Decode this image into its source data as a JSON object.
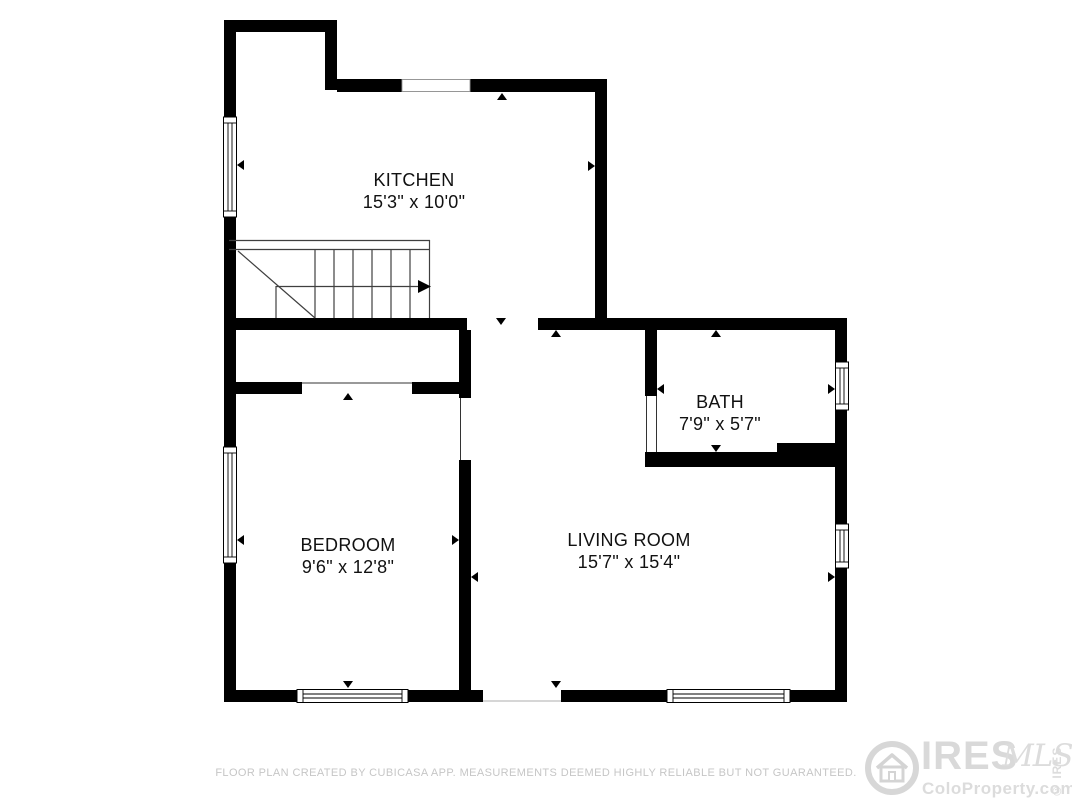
{
  "rooms": [
    {
      "name": "KITCHEN",
      "dims": "15'3\" x 10'0\"",
      "cx": 414,
      "cy": 180
    },
    {
      "name": "BATH",
      "dims": "7'9\" x 5'7\"",
      "cx": 720,
      "cy": 402
    },
    {
      "name": "BEDROOM",
      "dims": "9'6\" x 12'8\"",
      "cx": 348,
      "cy": 545
    },
    {
      "name": "LIVING ROOM",
      "dims": "15'7\" x 15'4\"",
      "cx": 629,
      "cy": 540
    }
  ],
  "plan": {
    "wall_color": "#000000",
    "stair_line_color": "#3f3f3f",
    "window_line_color": "#000000",
    "faint_line_color": "#c8c8c8",
    "walls": [
      [
        224,
        20,
        113,
        12
      ],
      [
        224,
        20,
        12,
        682
      ],
      [
        325,
        20,
        12,
        70
      ],
      [
        337,
        79,
        270,
        13
      ],
      [
        595,
        79,
        12,
        251
      ],
      [
        224,
        318,
        243,
        12
      ],
      [
        538,
        318,
        309,
        12
      ],
      [
        224,
        382,
        78,
        12
      ],
      [
        412,
        382,
        59,
        12
      ],
      [
        459,
        330,
        12,
        68
      ],
      [
        459,
        460,
        12,
        242
      ],
      [
        645,
        330,
        12,
        66
      ],
      [
        645,
        452,
        132,
        15
      ],
      [
        777,
        443,
        70,
        24
      ],
      [
        835,
        318,
        12,
        384
      ],
      [
        224,
        690,
        73,
        12
      ],
      [
        408,
        690,
        75,
        12
      ],
      [
        561,
        690,
        106,
        12
      ],
      [
        790,
        690,
        57,
        12
      ]
    ],
    "windows": [
      {
        "x": 402,
        "y": 79.5,
        "w": 68,
        "h": 12,
        "o": "h",
        "full": false
      },
      {
        "x": 223.5,
        "y": 117,
        "w": 13,
        "h": 100,
        "o": "v",
        "full": true
      },
      {
        "x": 223.5,
        "y": 447,
        "w": 13,
        "h": 116,
        "o": "v",
        "full": true
      },
      {
        "x": 835.5,
        "y": 362,
        "w": 13,
        "h": 48,
        "o": "v",
        "full": true
      },
      {
        "x": 835.5,
        "y": 524,
        "w": 13,
        "h": 44,
        "o": "v",
        "full": true
      },
      {
        "x": 297,
        "y": 689.5,
        "w": 111,
        "h": 13,
        "o": "h",
        "full": true
      },
      {
        "x": 667,
        "y": 689.5,
        "w": 123,
        "h": 13,
        "o": "h",
        "full": true
      }
    ],
    "opening_lines": [
      {
        "x1": 302,
        "y1": 383,
        "x2": 412,
        "y2": 383,
        "c": "#333333",
        "w": 1
      },
      {
        "x1": 460.5,
        "y1": 398,
        "x2": 460.5,
        "y2": 460,
        "c": "#333333",
        "w": 1
      },
      {
        "x1": 646.5,
        "y1": 396,
        "x2": 646.5,
        "y2": 452,
        "c": "#333333",
        "w": 1
      },
      {
        "x1": 656.5,
        "y1": 396,
        "x2": 656.5,
        "y2": 452,
        "c": "#333333",
        "w": 1
      },
      {
        "x1": 483,
        "y1": 701,
        "x2": 561,
        "y2": 701,
        "c": "#c8c8c8",
        "w": 1.5
      }
    ],
    "stairs": {
      "lines": [
        [
          229,
          240.5,
          430,
          240.5
        ],
        [
          229,
          249.5,
          430,
          249.5
        ],
        [
          429.5,
          240,
          429.5,
          318
        ],
        [
          315,
          249,
          315,
          318
        ],
        [
          334,
          249,
          334,
          318
        ],
        [
          353,
          249,
          353,
          318
        ],
        [
          372,
          249,
          372,
          318
        ],
        [
          391,
          249,
          391,
          318
        ],
        [
          410,
          249,
          410,
          318
        ],
        [
          276,
          286,
          276,
          318
        ],
        [
          238,
          251,
          315,
          318
        ],
        [
          276,
          286.5,
          418,
          286.5
        ]
      ],
      "arrow_head": "418,280 431,286.5 418,293"
    },
    "markers": [
      {
        "x": 502,
        "y": 97,
        "dir": "up"
      },
      {
        "x": 241,
        "y": 165,
        "dir": "left"
      },
      {
        "x": 591,
        "y": 166,
        "dir": "right"
      },
      {
        "x": 501,
        "y": 321,
        "dir": "down"
      },
      {
        "x": 716,
        "y": 334,
        "dir": "up"
      },
      {
        "x": 716,
        "y": 448,
        "dir": "down"
      },
      {
        "x": 661,
        "y": 389,
        "dir": "left"
      },
      {
        "x": 831,
        "y": 389,
        "dir": "right"
      },
      {
        "x": 556,
        "y": 334,
        "dir": "up"
      },
      {
        "x": 556,
        "y": 684,
        "dir": "down"
      },
      {
        "x": 475,
        "y": 577,
        "dir": "left"
      },
      {
        "x": 831,
        "y": 577,
        "dir": "right"
      },
      {
        "x": 348,
        "y": 397,
        "dir": "up"
      },
      {
        "x": 348,
        "y": 684,
        "dir": "down"
      },
      {
        "x": 241,
        "y": 540,
        "dir": "left"
      },
      {
        "x": 455,
        "y": 540,
        "dir": "right"
      }
    ]
  },
  "footer": {
    "disclaimer": "FLOOR PLAN CREATED BY CUBICASA APP. MEASUREMENTS DEEMED HIGHLY RELIABLE BUT NOT GUARANTEED."
  },
  "watermark": {
    "brand": "IRES",
    "script": "MLS",
    "site": "ColoProperty.com",
    "copyright": "© IRES",
    "color": "#d9d9d9"
  }
}
